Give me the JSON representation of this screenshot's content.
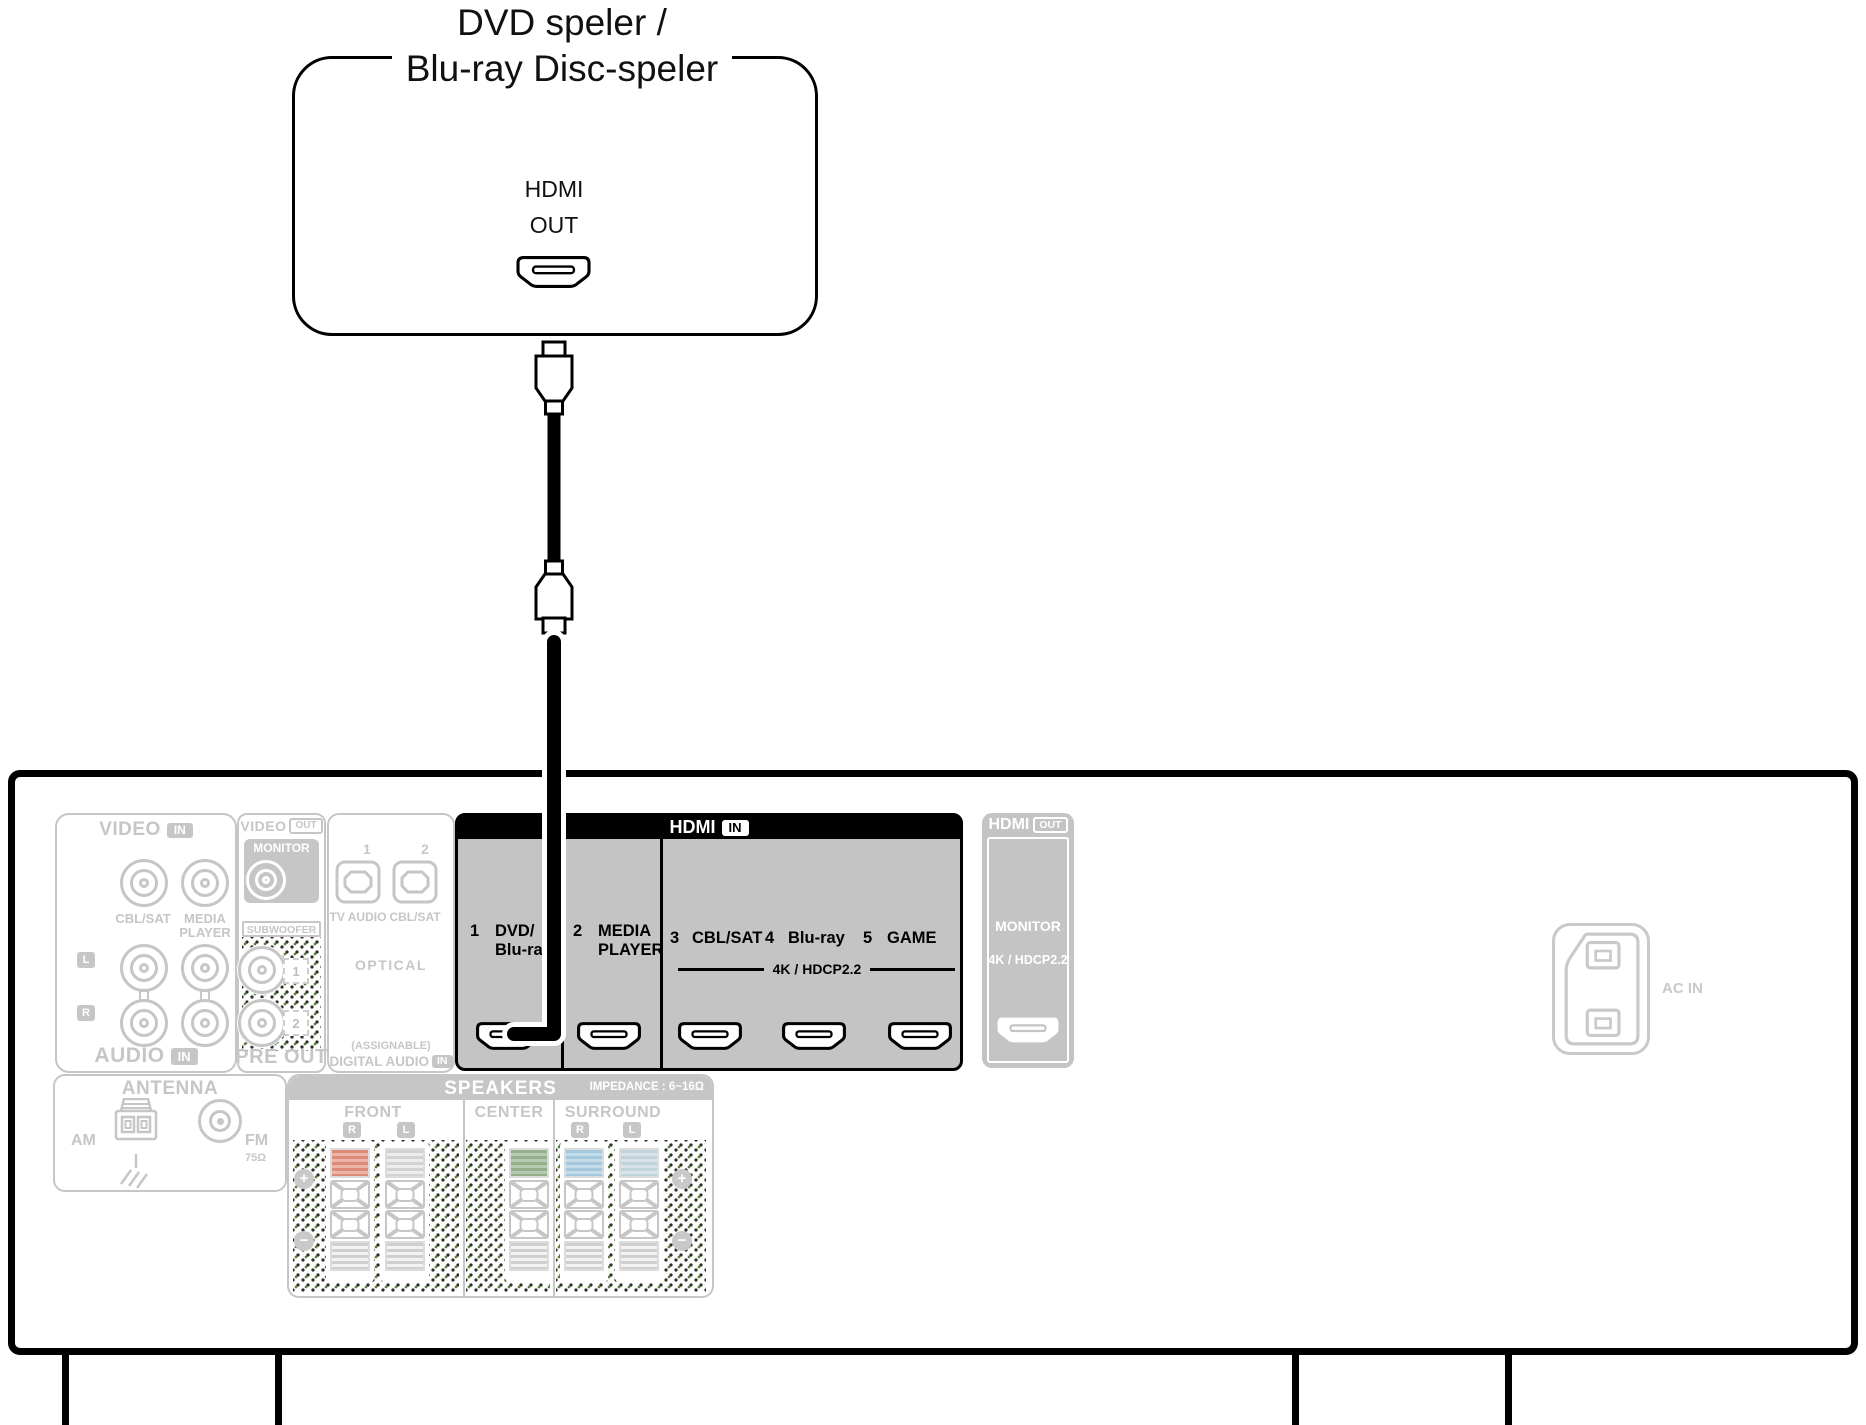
{
  "device": {
    "title_line1": "DVD speler /",
    "title_line2": "Blu-ray Disc-speler",
    "port_label_line1": "HDMI",
    "port_label_line2": "OUT"
  },
  "receiver": {
    "video_in": {
      "header": "VIDEO",
      "header_badge": "IN",
      "jack_top_labels": [
        "CBL/SAT",
        "MEDIA",
        "PLAYER"
      ],
      "channel_left": "L",
      "channel_right": "R",
      "footer": "AUDIO",
      "footer_badge": "IN"
    },
    "monitor_out": {
      "header": "VIDEO",
      "header_badge": "OUT",
      "label": "MONITOR"
    },
    "pre_out": {
      "subwoofer_label": "SUBWOOFER",
      "jack_numbers": [
        "1",
        "2"
      ],
      "footer": "PRE OUT"
    },
    "digital_audio": {
      "jack_numbers": [
        "1",
        "2"
      ],
      "jack_labels": [
        "TV AUDIO",
        "CBL/SAT"
      ],
      "type_label": "OPTICAL",
      "assignable_label": "(ASSIGNABLE)",
      "footer": "DIGITAL AUDIO",
      "footer_badge": "IN"
    },
    "hdmi_in": {
      "header": "HDMI",
      "header_badge": "IN",
      "ports": [
        {
          "num": "1",
          "label": "DVD/",
          "label2": "Blu-ray"
        },
        {
          "num": "2",
          "label": "MEDIA",
          "label2": "PLAYER"
        },
        {
          "num": "3",
          "label": "CBL/SAT"
        },
        {
          "num": "4",
          "label": "Blu-ray"
        },
        {
          "num": "5",
          "label": "GAME"
        }
      ],
      "hdcp_label": "4K / HDCP2.2"
    },
    "hdmi_out": {
      "header": "HDMI",
      "header_badge": "OUT",
      "label": "MONITOR",
      "hdcp_label": "4K / HDCP2.2"
    },
    "antenna": {
      "header": "ANTENNA",
      "am_label": "AM",
      "fm_label": "FM",
      "fm_impedance": "75Ω"
    },
    "speakers": {
      "header": "SPEAKERS",
      "impedance_label": "IMPEDANCE : 6~16Ω",
      "groups": [
        {
          "name": "FRONT",
          "channels": [
            "R",
            "L"
          ]
        },
        {
          "name": "CENTER",
          "channels": []
        },
        {
          "name": "SURROUND",
          "channels": [
            "R",
            "L"
          ]
        }
      ]
    },
    "ac_in_label": "AC IN"
  },
  "icons": {
    "plus": "+",
    "minus": "−"
  },
  "colors": {
    "disabled_gray": "#c6c6c6",
    "hdmi_body_gray": "#c4c4c4",
    "highlight_black": "#000000",
    "speaker_stripes": {
      "front_r": {
        "base": "#eeb4a8",
        "line": "#dd8b79"
      },
      "front_l": {
        "base": "#ededed",
        "line": "#d2d2d2"
      },
      "center": {
        "base": "#b6cab1",
        "line": "#93af8c"
      },
      "surround_r": {
        "base": "#c4dcea",
        "line": "#a3c8dd"
      },
      "surround_l": {
        "base": "#d8e3e8",
        "line": "#c0d3db"
      }
    }
  }
}
